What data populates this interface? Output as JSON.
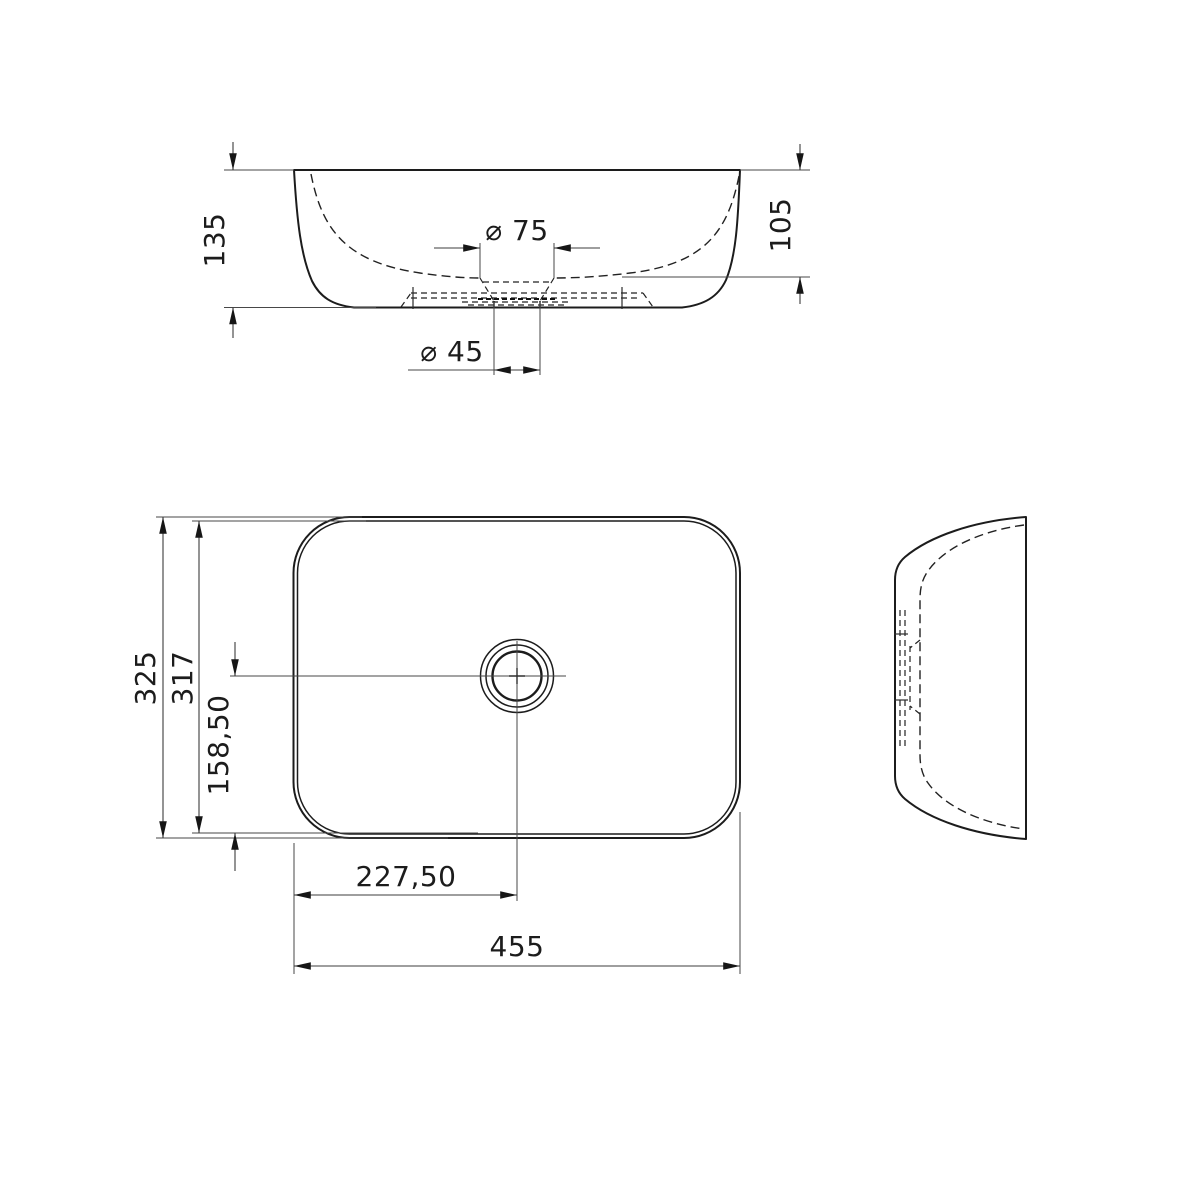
{
  "drawing": {
    "background_color": "#ffffff",
    "outline_color": "#1c1c1c",
    "construction_line_color": "#474747",
    "text_color": "#1c1c1c",
    "diameter_symbol": "⌀",
    "decimal_style": "comma"
  },
  "front_view": {
    "dims": {
      "overall_height": "135",
      "bowl_depth": "105",
      "recess_diameter": "⌀ 75",
      "drain_diameter": "⌀ 45"
    }
  },
  "plan_view": {
    "dims": {
      "overall_depth": "325",
      "base_depth": "317",
      "drain_offset_from_edge": "158,50",
      "drain_offset_from_left": "227,50",
      "overall_width": "455"
    }
  }
}
